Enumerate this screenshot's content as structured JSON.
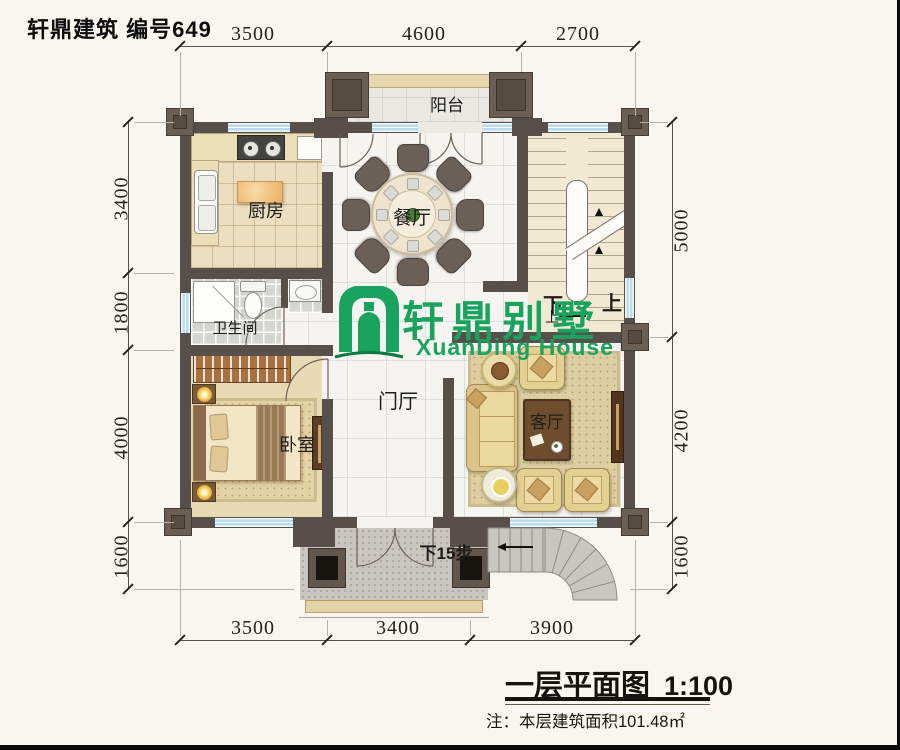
{
  "header": {
    "brand": "轩鼎建筑 编号649"
  },
  "titleblock": {
    "title": "一层平面图",
    "scale": "1:100",
    "note": "注：本层建筑面积101.48㎡"
  },
  "logo": {
    "cn": "轩鼎别墅",
    "en": "XuanDing House",
    "green": "#1aa35e"
  },
  "rooms": {
    "balcony": "阳台",
    "kitchen": "厨房",
    "dining": "餐厅",
    "bath": "卫生间",
    "bedroom": "卧室",
    "foyer": "门厅",
    "living": "客厅"
  },
  "stairs": {
    "down": "下",
    "up": "上",
    "up_small": "上",
    "porch_steps": "下15步"
  },
  "dims": {
    "top": [
      "3500",
      "4600",
      "2700"
    ],
    "bottom": [
      "3500",
      "3400",
      "3900"
    ],
    "left": [
      "3400",
      "1800",
      "4000",
      "1600"
    ],
    "right": [
      "5000",
      "4200",
      "1600"
    ]
  },
  "colors": {
    "wall": "#57504a",
    "window": "#b9ddee",
    "logo_green": "#1aa35e"
  }
}
